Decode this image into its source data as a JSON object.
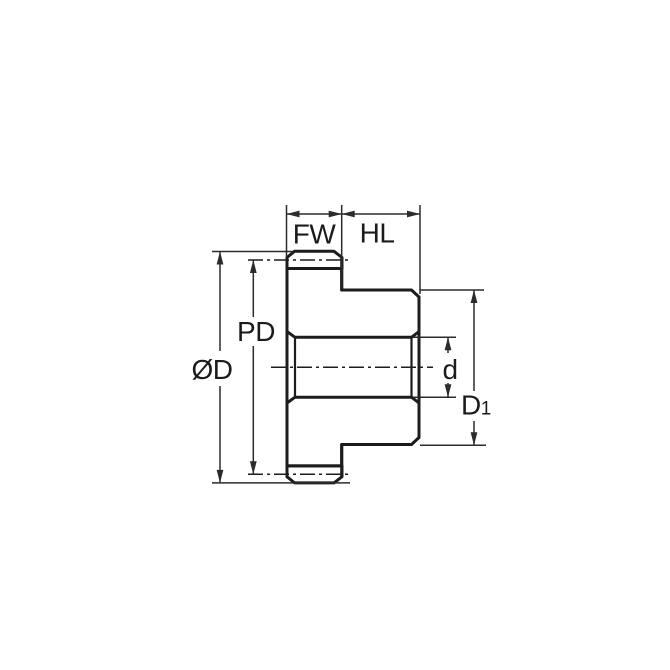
{
  "diagram": {
    "type": "technical-drawing",
    "subject": "spur gear with hub - side cross-section with dimension callouts",
    "labels": {
      "face_width": "FW",
      "hub_length": "HL",
      "outside_diameter": "ØD",
      "pitch_diameter": "PD",
      "bore_diameter": "d",
      "hub_diameter_base": "D",
      "hub_diameter_subscript": "1"
    },
    "colors": {
      "part_fill": "#C9E6F8",
      "tooth_fill": "#FFFFFF",
      "line": "#1C1C1C",
      "dim_line": "#2B2B2B",
      "background": "#FFFFFF"
    }
  }
}
